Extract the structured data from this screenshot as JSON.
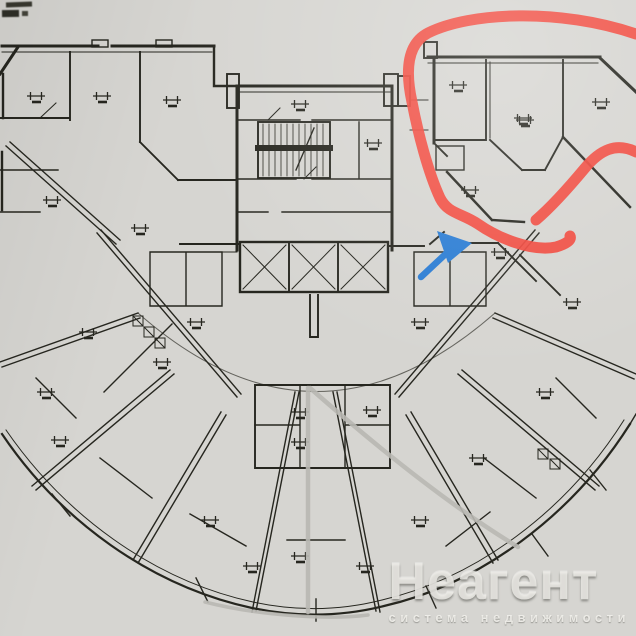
{
  "watermark": {
    "brand": "Неагент",
    "tagline": "система недвижимости"
  },
  "annotations": {
    "highlight_circle_color": "#f2453a",
    "arrow_color": "#2a7cd3",
    "pencil_line_color": "#b9b8b2"
  },
  "colors": {
    "paper": "#d6d5d1",
    "ink": "#26261f"
  }
}
